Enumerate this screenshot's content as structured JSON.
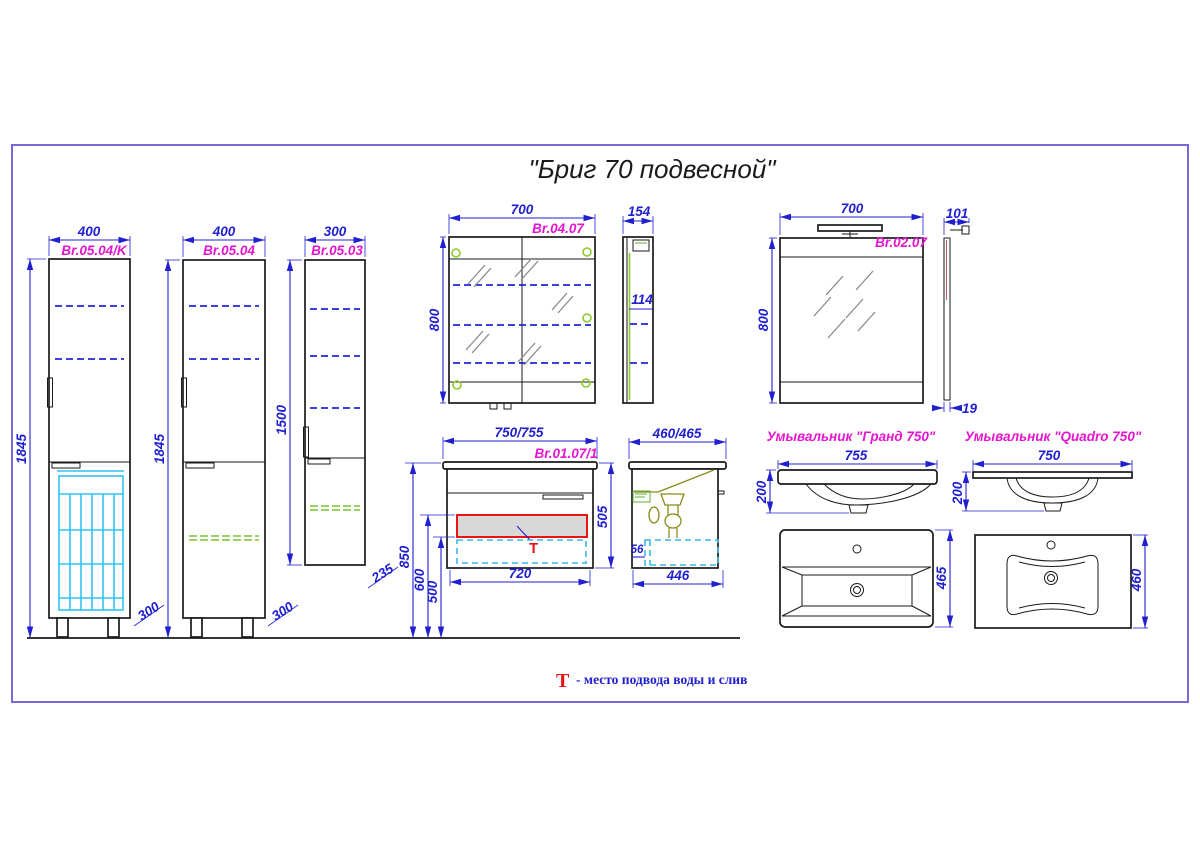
{
  "title": "\"Бриг 70 подвесной\"",
  "legend": {
    "symbol": "Т",
    "text": "- место подвода воды и слив"
  },
  "colors": {
    "outline": "#1a1a1a",
    "dimension_blue": "#2020d0",
    "label_magenta": "#e515cf",
    "frame_purple": "#7668d8",
    "basket_cyan": "#2fc4f2",
    "shelf_dashed_blue": "#2026dd",
    "shelf_dashed_green": "#7cc230",
    "hinge_green": "#8ccb2a",
    "highlight_red": "#e81515",
    "drawer_fill_gray": "#d8d8d8"
  },
  "components": {
    "cabinet_k": {
      "code": "Br.05.04/K",
      "width": "400",
      "height": "1845",
      "depth": "300"
    },
    "cabinet": {
      "code": "Br.05.04",
      "width": "400",
      "height": "1845",
      "depth": "300"
    },
    "column": {
      "code": "Br.05.03",
      "width": "300",
      "height": "1500",
      "depth": "235"
    },
    "mirror_cabinet": {
      "code": "Br.04.07",
      "width": "700",
      "height": "800",
      "depth": "154",
      "shelf_depth": "114"
    },
    "mirror": {
      "code": "Br.02.07",
      "width": "700",
      "height": "800",
      "lamp_depth": "101",
      "thickness": "19"
    },
    "vanity": {
      "code": "Br.01.07/1",
      "width": "750/755",
      "height": "505",
      "case_width": "720",
      "mount_height": "850",
      "drain_height": "600",
      "supply_height": "500",
      "t_symbol": "Т"
    },
    "vanity_side": {
      "width": "460/465",
      "case_depth": "446",
      "offset": "56"
    },
    "sink_grand": {
      "name": "Умывальник \"Гранд 750\"",
      "width": "755",
      "height": "200",
      "depth": "465"
    },
    "sink_quadro": {
      "name": "Умывальник \"Quadro 750\"",
      "width": "750",
      "height": "200",
      "depth": "460"
    }
  }
}
